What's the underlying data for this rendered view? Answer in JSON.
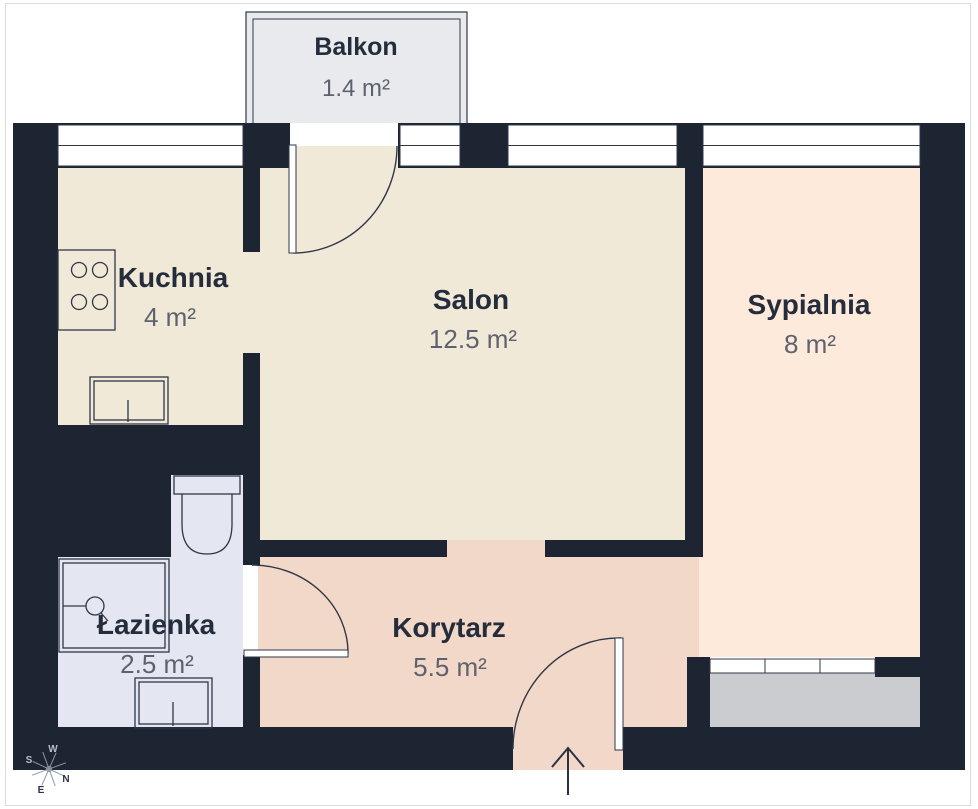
{
  "plan": {
    "type": "apartment-floor-plan",
    "rooms": [
      {
        "id": "balkon",
        "name": "Balkon",
        "area": "1.4 m²"
      },
      {
        "id": "kuchnia",
        "name": "Kuchnia",
        "area": "4 m²"
      },
      {
        "id": "salon",
        "name": "Salon",
        "area": "12.5 m²"
      },
      {
        "id": "sypialnia",
        "name": "Sypialnia",
        "area": "8 m²"
      },
      {
        "id": "lazienka",
        "name": "Łazienka",
        "area": "2.5 m²"
      },
      {
        "id": "korytarz",
        "name": "Korytarz",
        "area": "5.5 m²"
      }
    ],
    "compass": {
      "n": "N",
      "e": "E",
      "s": "S",
      "w": "W"
    }
  },
  "colors": {
    "wall": "#1d2532",
    "line": "#2f3747",
    "cream": "#f0e9d7",
    "peach": "#fdeadb",
    "salmon": "#f2d8c8",
    "lavender": "#e4e7f1",
    "balcony_gray": "#e8eaee",
    "loggia_gray": "#cbccd0",
    "window_white": "#ffffff",
    "name_text": "#252d3d",
    "area_text": "#5d626e",
    "frame": "#dcdcdc",
    "compass_light": "#b9bfca",
    "compass_dark": "#2a3242"
  }
}
